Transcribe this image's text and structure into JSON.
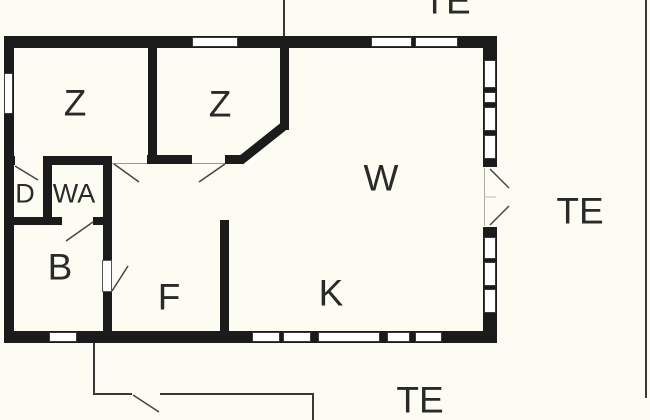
{
  "rooms": {
    "z1": {
      "label": "Z"
    },
    "z2": {
      "label": "Z"
    },
    "w": {
      "label": "W"
    },
    "d": {
      "label": "D"
    },
    "wa": {
      "label": "WA"
    },
    "b": {
      "label": "B"
    },
    "f": {
      "label": "F"
    },
    "k": {
      "label": "K"
    }
  },
  "terraces": {
    "top": {
      "label": "TE"
    },
    "right": {
      "label": "TE"
    },
    "bottom": {
      "label": "TE"
    }
  },
  "colors": {
    "bg": "#fcfcf3",
    "wall": "#1b1b1b",
    "text": "#2a2a2a",
    "line": "#3a3a3a",
    "winborder": "#3a3a3a"
  }
}
